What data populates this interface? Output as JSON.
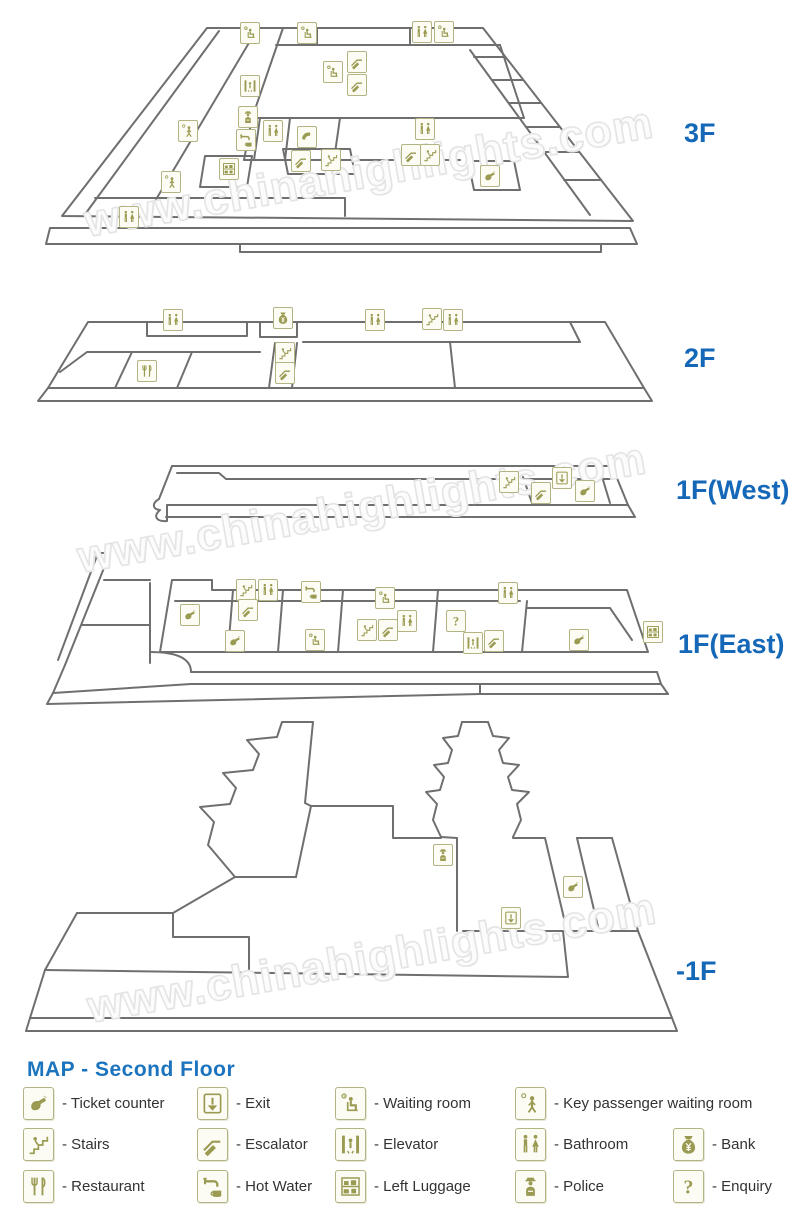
{
  "watermark": {
    "text": "www.chinahighlights.com"
  },
  "colors": {
    "label_blue": "#1568b8",
    "title_blue": "#1b74bd",
    "icon_olive": "#9a9a52",
    "icon_border": "#b3b383",
    "icon_bg": "#fcfcf4",
    "line_gray": "#6f6f6f",
    "legend_text": "#333333"
  },
  "floors": [
    {
      "id": "3f",
      "label": "3F",
      "icons": [
        {
          "t": "waiting-room",
          "x": 250,
          "y": 33
        },
        {
          "t": "waiting-room",
          "x": 307,
          "y": 33
        },
        {
          "t": "bathroom",
          "x": 422,
          "y": 32
        },
        {
          "t": "waiting-room",
          "x": 444,
          "y": 32
        },
        {
          "t": "escalator",
          "x": 357,
          "y": 62
        },
        {
          "t": "waiting-room",
          "x": 333,
          "y": 72
        },
        {
          "t": "escalator",
          "x": 357,
          "y": 85
        },
        {
          "t": "elevator",
          "x": 250,
          "y": 86
        },
        {
          "t": "police",
          "x": 248,
          "y": 117
        },
        {
          "t": "key-passenger",
          "x": 188,
          "y": 131
        },
        {
          "t": "bathroom",
          "x": 273,
          "y": 131
        },
        {
          "t": "telephone",
          "x": 307,
          "y": 137
        },
        {
          "t": "hot-water",
          "x": 246,
          "y": 140
        },
        {
          "t": "escalator",
          "x": 301,
          "y": 161
        },
        {
          "t": "stairs",
          "x": 331,
          "y": 160
        },
        {
          "t": "left-luggage",
          "x": 229,
          "y": 169
        },
        {
          "t": "key-passenger",
          "x": 171,
          "y": 182
        },
        {
          "t": "bathroom",
          "x": 129,
          "y": 217
        },
        {
          "t": "bathroom",
          "x": 425,
          "y": 129
        },
        {
          "t": "escalator",
          "x": 411,
          "y": 155
        },
        {
          "t": "stairs",
          "x": 430,
          "y": 155
        },
        {
          "t": "ticket-counter",
          "x": 490,
          "y": 176
        }
      ]
    },
    {
      "id": "2f",
      "label": "2F",
      "icons": [
        {
          "t": "bathroom",
          "x": 173,
          "y": 320
        },
        {
          "t": "bank",
          "x": 283,
          "y": 318
        },
        {
          "t": "bathroom",
          "x": 375,
          "y": 320
        },
        {
          "t": "stairs",
          "x": 432,
          "y": 319
        },
        {
          "t": "bathroom",
          "x": 453,
          "y": 320
        },
        {
          "t": "restaurant",
          "x": 147,
          "y": 371
        },
        {
          "t": "stairs",
          "x": 285,
          "y": 353
        },
        {
          "t": "escalator",
          "x": 285,
          "y": 373
        }
      ]
    },
    {
      "id": "1fw",
      "label": "1F(West)",
      "icons": [
        {
          "t": "stairs",
          "x": 509,
          "y": 482
        },
        {
          "t": "escalator",
          "x": 541,
          "y": 493
        },
        {
          "t": "exit",
          "x": 562,
          "y": 478
        },
        {
          "t": "ticket-counter",
          "x": 585,
          "y": 491
        }
      ]
    },
    {
      "id": "1fe",
      "label": "1F(East)",
      "icons": [
        {
          "t": "ticket-counter",
          "x": 190,
          "y": 615
        },
        {
          "t": "stairs",
          "x": 246,
          "y": 590
        },
        {
          "t": "bathroom",
          "x": 268,
          "y": 590
        },
        {
          "t": "escalator",
          "x": 248,
          "y": 610
        },
        {
          "t": "ticket-counter",
          "x": 235,
          "y": 641
        },
        {
          "t": "hot-water",
          "x": 311,
          "y": 592
        },
        {
          "t": "waiting-room",
          "x": 315,
          "y": 640
        },
        {
          "t": "waiting-room",
          "x": 385,
          "y": 598
        },
        {
          "t": "stairs",
          "x": 367,
          "y": 630
        },
        {
          "t": "escalator",
          "x": 388,
          "y": 630
        },
        {
          "t": "bathroom",
          "x": 407,
          "y": 621
        },
        {
          "t": "enquiry",
          "x": 456,
          "y": 621
        },
        {
          "t": "elevator",
          "x": 473,
          "y": 643
        },
        {
          "t": "escalator",
          "x": 494,
          "y": 641
        },
        {
          "t": "bathroom",
          "x": 508,
          "y": 593
        },
        {
          "t": "ticket-counter",
          "x": 579,
          "y": 640
        },
        {
          "t": "left-luggage",
          "x": 653,
          "y": 632
        }
      ]
    },
    {
      "id": "b1",
      "label": "-1F",
      "icons": [
        {
          "t": "police",
          "x": 443,
          "y": 855
        },
        {
          "t": "exit",
          "x": 511,
          "y": 918
        },
        {
          "t": "ticket-counter",
          "x": 573,
          "y": 887
        }
      ]
    }
  ],
  "legend": {
    "title": "MAP - Second Floor",
    "label_prefix": "- ",
    "items": [
      {
        "icon": "ticket-counter",
        "label": "Ticket counter",
        "col": 0,
        "row": 0
      },
      {
        "icon": "exit",
        "label": "Exit",
        "col": 1,
        "row": 0
      },
      {
        "icon": "waiting-room",
        "label": "Waiting room",
        "col": 2,
        "row": 0
      },
      {
        "icon": "key-passenger",
        "label": "Key passenger waiting room",
        "col": 3,
        "row": 0
      },
      {
        "icon": "stairs",
        "label": "Stairs",
        "col": 0,
        "row": 1
      },
      {
        "icon": "escalator",
        "label": "Escalator",
        "col": 1,
        "row": 1
      },
      {
        "icon": "elevator",
        "label": "Elevator",
        "col": 2,
        "row": 1
      },
      {
        "icon": "bathroom",
        "label": "Bathroom",
        "col": 3,
        "row": 1
      },
      {
        "icon": "bank",
        "label": "Bank",
        "col": 4,
        "row": 1
      },
      {
        "icon": "restaurant",
        "label": "Restaurant",
        "col": 0,
        "row": 2
      },
      {
        "icon": "hot-water",
        "label": "Hot Water",
        "col": 1,
        "row": 2
      },
      {
        "icon": "left-luggage",
        "label": "Left Luggage",
        "col": 2,
        "row": 2
      },
      {
        "icon": "police",
        "label": "Police",
        "col": 3,
        "row": 2
      },
      {
        "icon": "enquiry",
        "label": "Enquiry",
        "col": 4,
        "row": 2
      }
    ]
  }
}
